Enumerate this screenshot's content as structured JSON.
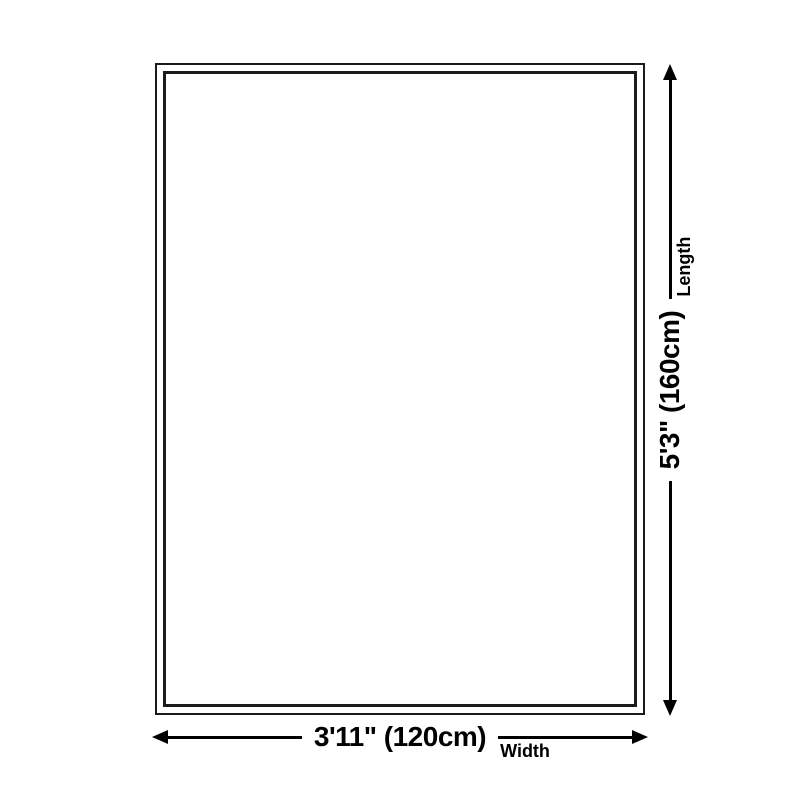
{
  "diagram": {
    "length_dimension": {
      "value": "5'3\" (160cm)",
      "label": "Length"
    },
    "width_dimension": {
      "value": "3'11\" (120cm)",
      "label": "Width"
    }
  },
  "colors": {
    "background": "#ffffff",
    "outline": "#1b1b1b",
    "dimension_line": "#000000",
    "text": "#000000"
  }
}
